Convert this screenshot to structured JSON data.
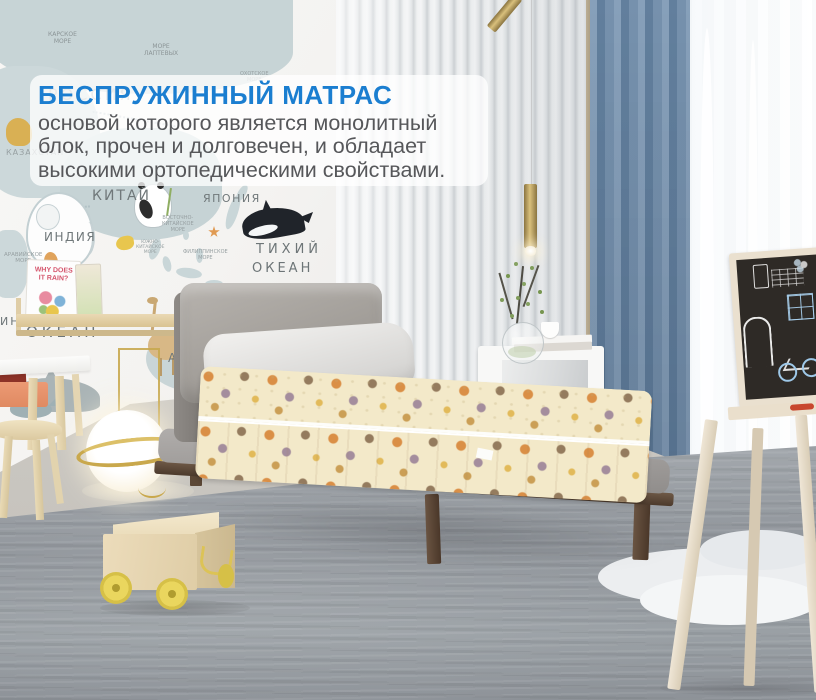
{
  "overlay": {
    "title": "БЕСПРУЖИННЫЙ МАТРАС",
    "body": "основой которого является монолитный\nблок, прочен и долговечен, и обладает\nвысокими ортопедическими свойствами.",
    "title_color": "#1b7ed0",
    "body_color": "#56575a",
    "panel_color": "rgba(255,255,255,0.76)"
  },
  "map": {
    "book_title": "WHY DOES\nIT RAIN?",
    "labels": [
      {
        "text": "КАРСКОЕ\nМОРЕ",
        "x": 48,
        "y": 32,
        "size": 6,
        "color": "#8b9496"
      },
      {
        "text": "МОРЕ\nЛАПТЕВЫХ",
        "x": 144,
        "y": 44,
        "size": 6,
        "color": "#8b9496"
      },
      {
        "text": "ОХОТСКОЕ\nМОРЕ",
        "x": 240,
        "y": 72,
        "size": 5,
        "color": "#97a0a2"
      },
      {
        "text": "РОССИЯ",
        "x": 48,
        "y": 86,
        "size": 16,
        "spacing": 3,
        "color": "#788082",
        "opacity": 0.55
      },
      {
        "text": "КАЗАХСТАН",
        "x": 6,
        "y": 148,
        "size": 8,
        "spacing": 1,
        "color": "#97a0a2"
      },
      {
        "text": "КИТАЙ",
        "x": 92,
        "y": 188,
        "size": 14,
        "spacing": 2,
        "color": "#70787a"
      },
      {
        "text": "ЯПОНИЯ",
        "x": 203,
        "y": 193,
        "size": 11,
        "spacing": 1.5,
        "color": "#70787a"
      },
      {
        "text": "ИНДИЯ",
        "x": 44,
        "y": 231,
        "size": 12,
        "spacing": 1.5,
        "color": "#70787a"
      },
      {
        "text": "ВОСТОЧНО-\nКИТАЙСКОЕ\nМОРЕ",
        "x": 162,
        "y": 216,
        "size": 5,
        "color": "#97a0a2"
      },
      {
        "text": "ЮЖНО-\nКИТАЙСКОЕ\nМОРЕ",
        "x": 136,
        "y": 240,
        "size": 4.5,
        "color": "#97a0a2"
      },
      {
        "text": "ФИЛИППИНСКОЕ\nМОРЕ",
        "x": 183,
        "y": 250,
        "size": 5,
        "color": "#97a0a2"
      },
      {
        "text": "АРАВИЙСКОЕ\nМОРЕ",
        "x": 4,
        "y": 252,
        "size": 5.5,
        "color": "#97a0a2"
      },
      {
        "text": "ТИХИЙ",
        "x": 256,
        "y": 243,
        "size": 13,
        "spacing": 4,
        "color": "#6d7577"
      },
      {
        "text": "ОКЕАН",
        "x": 252,
        "y": 262,
        "size": 13,
        "spacing": 3,
        "color": "#6d7577"
      },
      {
        "text": "ОКЕАН",
        "x": 26,
        "y": 324,
        "size": 15,
        "spacing": 4,
        "color": "#6d7577"
      },
      {
        "text": "ИНД",
        "x": 0,
        "y": 316,
        "size": 11,
        "spacing": 2,
        "color": "#6d7577"
      },
      {
        "text": "АВС",
        "x": 168,
        "y": 352,
        "size": 12,
        "spacing": 2,
        "color": "#70787a"
      }
    ]
  },
  "colors": {
    "accent_blue": "#1b7ed0",
    "curtain_blue": "#7691ad",
    "mattress_cream": "#f3e9c9",
    "wood_walnut": "#5c4836",
    "wheel_yellow": "#e6d153"
  }
}
